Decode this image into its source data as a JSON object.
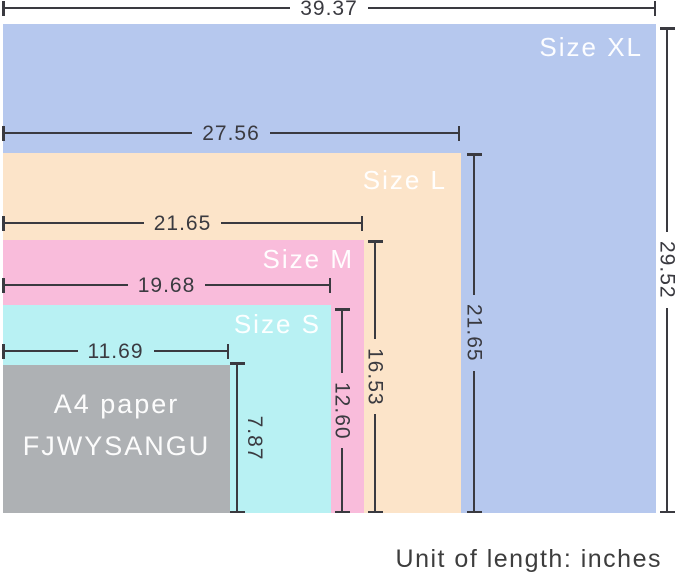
{
  "diagram": {
    "description_colors": {
      "size_xl": "#b6c8ee",
      "size_l": "#fce4c9",
      "size_m": "#f9bcdb",
      "size_s": "#b8f1f3",
      "a4": "#aeb1b4",
      "dimension_lines": "#3a3a40",
      "label_text": "#ffffff"
    },
    "sizes": {
      "xl": {
        "label": "Size XL",
        "width": "39.37",
        "height": "29.52",
        "color": "#b6c8ee"
      },
      "l": {
        "label": "Size L",
        "width": "27.56",
        "height": "21.65",
        "color": "#fce4c9"
      },
      "m": {
        "label": "Size M",
        "width": "21.65",
        "height": "16.53",
        "color": "#f9bcdb"
      },
      "s": {
        "label": "Size S",
        "width": "19.68",
        "height": "12.60",
        "color": "#b8f1f3"
      },
      "a4": {
        "label_line1": "A4 paper",
        "label_line2": "FJWYSANGU",
        "width": "11.69",
        "height": "7.87",
        "color": "#aeb1b4"
      }
    },
    "footer": {
      "text": "Unit of length: inches"
    }
  }
}
